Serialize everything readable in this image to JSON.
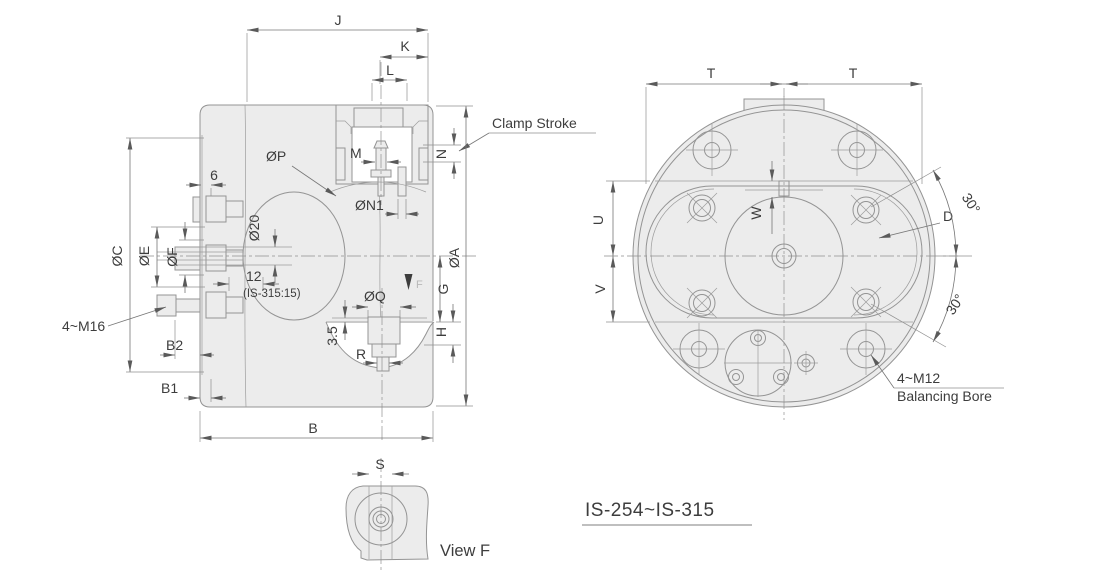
{
  "colors": {
    "body_fill": "#ececec",
    "geometry_line": "#949494",
    "dimension_line": "#777777",
    "text": "#3d3d3d",
    "background": "#ffffff"
  },
  "title": {
    "model_range": "IS-254~IS-315"
  },
  "section_view": {
    "labels": {
      "j": "J",
      "k": "K",
      "l": "L",
      "m": "M",
      "n": "N",
      "six": "6",
      "phi_p": "ØP",
      "phi_n1": "ØN1",
      "phi_20": "Ø20",
      "phi_c": "ØC",
      "phi_e": "ØE",
      "phi_f": "ØF",
      "twelve": "12",
      "twelve_note": "(IS-315:15)",
      "phi_a": "ØA",
      "g": "G",
      "phi_q": "ØQ",
      "h": "H",
      "three_five": "3.5",
      "r": "R",
      "bolt_spec": "4~M16",
      "b2": "B2",
      "b1": "B1",
      "b": "B",
      "clamp_stroke": "Clamp Stroke",
      "view_direction": "F"
    }
  },
  "front_view": {
    "labels": {
      "t_left": "T",
      "t_right": "T",
      "u": "U",
      "v": "V",
      "w": "W",
      "d": "D",
      "angle_upper": "30°",
      "angle_lower": "30°",
      "balance_qty": "4~M12",
      "balance_name": "Balancing Bore"
    }
  },
  "detail_view": {
    "labels": {
      "s": "S"
    },
    "caption": "View F"
  }
}
